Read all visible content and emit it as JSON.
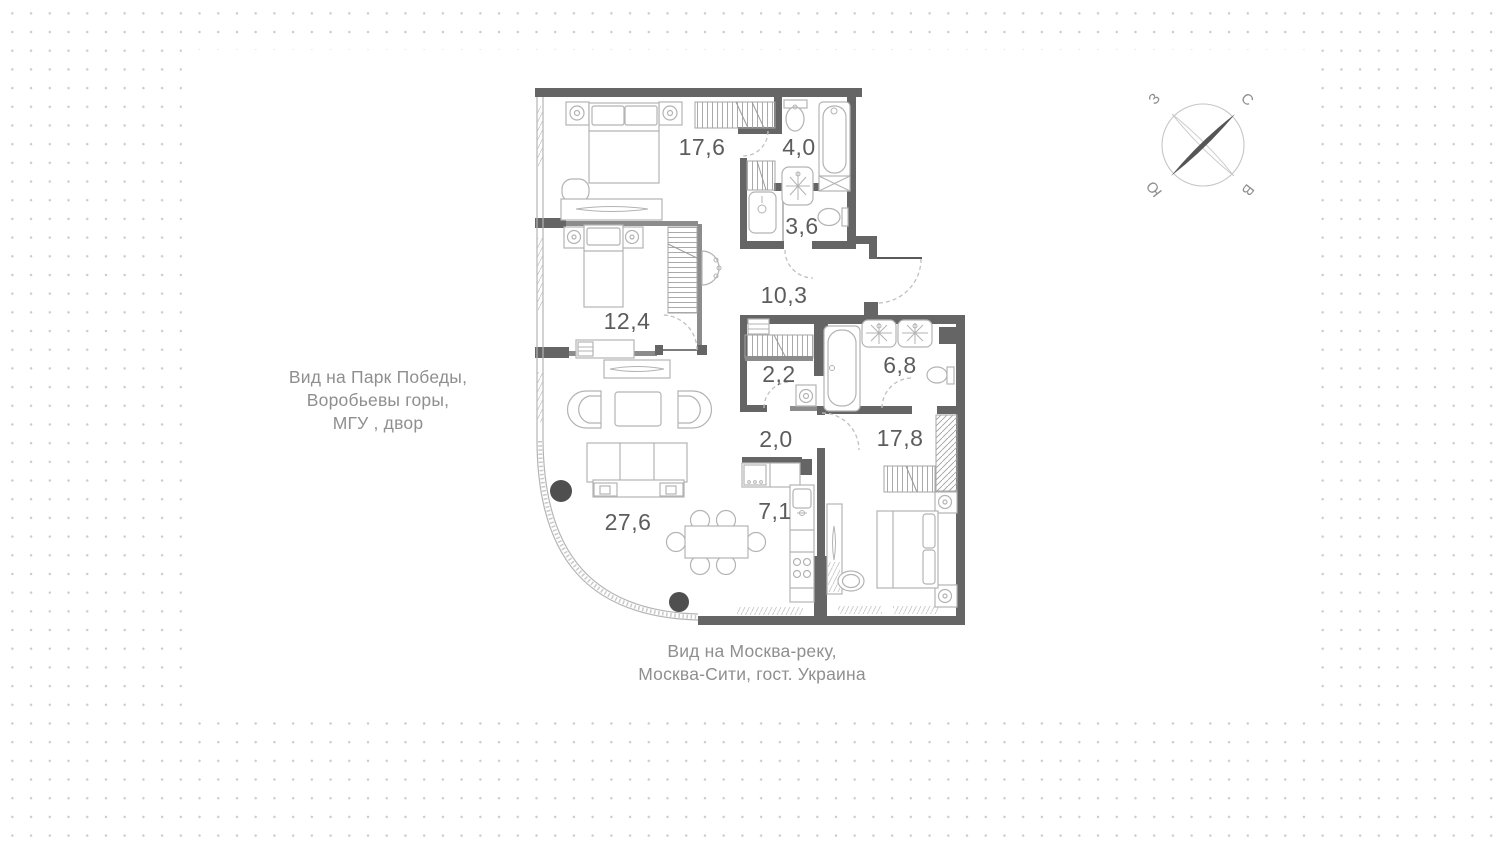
{
  "plan": {
    "rooms": [
      {
        "name": "bedroom-1",
        "area": "17,6"
      },
      {
        "name": "bathroom-1",
        "area": "4,0"
      },
      {
        "name": "wc",
        "area": "3,6"
      },
      {
        "name": "bedroom-2",
        "area": "12,4"
      },
      {
        "name": "hallway",
        "area": "10,3"
      },
      {
        "name": "wardrobe",
        "area": "2,2"
      },
      {
        "name": "bathroom-2",
        "area": "6,8"
      },
      {
        "name": "corridor",
        "area": "2,0"
      },
      {
        "name": "bedroom-3",
        "area": "17,8"
      },
      {
        "name": "living-room",
        "area": "27,6"
      },
      {
        "name": "kitchen",
        "area": "7,1"
      }
    ]
  },
  "views": {
    "left": [
      "Вид на  Парк Победы,",
      "Воробьевы горы,",
      "МГУ , двор"
    ],
    "bottom": [
      "Вид на Москва-реку,",
      "Москва-Сити, гост. Украина"
    ]
  },
  "compass": {
    "north": "С",
    "south": "Ю",
    "west": "З",
    "east": "В"
  },
  "colors": {
    "wall": "#656565",
    "furniture": "#b3b3b3",
    "label": "#5c5c5c",
    "view_text": "#8f8f8f"
  }
}
